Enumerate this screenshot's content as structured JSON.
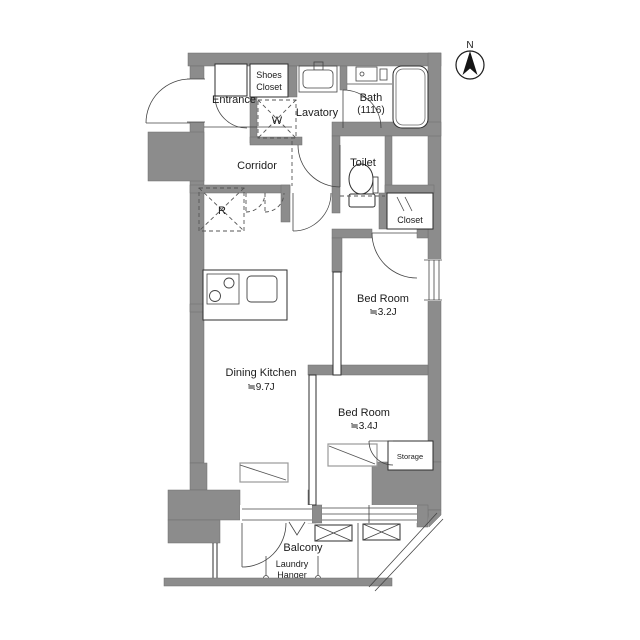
{
  "plan": {
    "compass": {
      "north_label": "N"
    },
    "rooms": {
      "entrance": {
        "label": "Entrance"
      },
      "shoes_closet": {
        "line1": "Shoes",
        "line2": "Closet"
      },
      "lavatory": {
        "label": "Lavatory"
      },
      "washing_machine": {
        "label": "W"
      },
      "bath": {
        "label": "Bath",
        "size": "(1116)"
      },
      "corridor": {
        "label": "Corridor"
      },
      "toilet": {
        "label": "Toilet"
      },
      "refrigerator": {
        "label": "R"
      },
      "closet": {
        "label": "Closet"
      },
      "bedroom_1": {
        "label": "Bed Room",
        "size": "≒3.2J"
      },
      "dining_kitchen": {
        "label": "Dining Kitchen",
        "size": "≒9.7J"
      },
      "bedroom_2": {
        "label": "Bed Room",
        "size": "≒3.4J"
      },
      "storage": {
        "label": "Storage"
      },
      "balcony": {
        "label": "Balcony"
      },
      "laundry_hanger": {
        "line1": "Laundry",
        "line2": "Hanger"
      }
    },
    "colors": {
      "wall": "#8c8c8c",
      "line": "#2e2e2e",
      "background": "#ffffff"
    }
  }
}
